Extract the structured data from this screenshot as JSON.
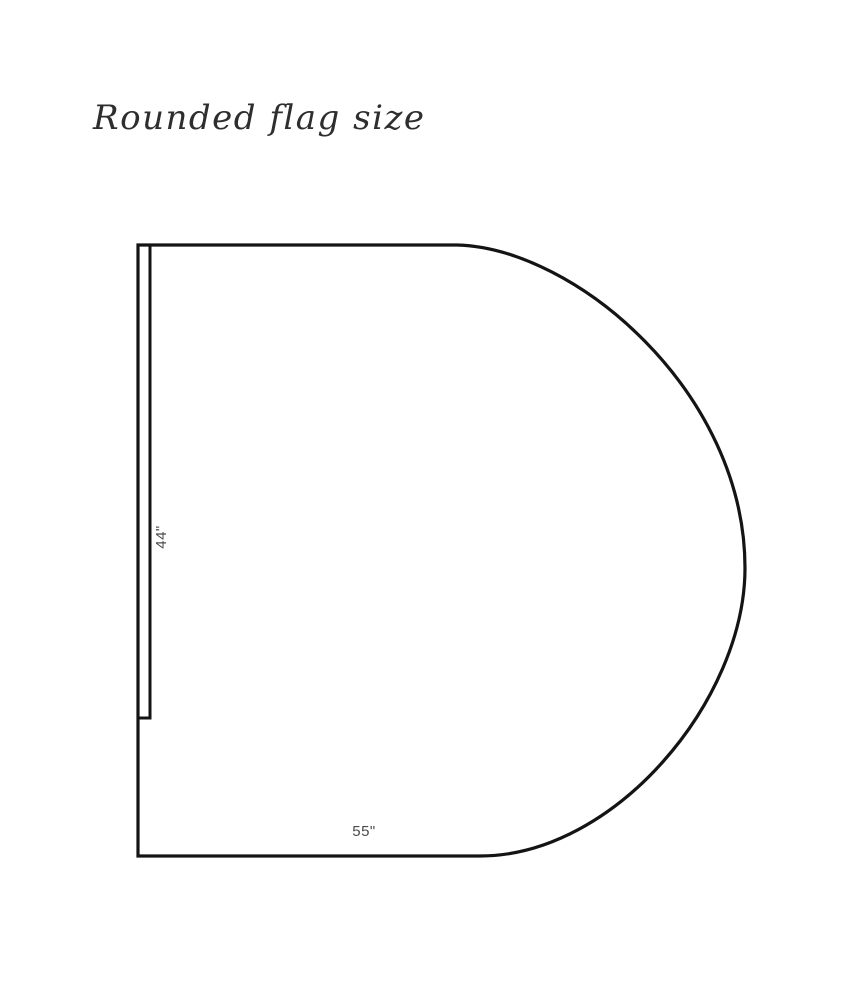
{
  "title": {
    "text": "Rounded flag size"
  },
  "flag": {
    "height_label": "44\"",
    "width_label": "55\"",
    "outline_color": "#141414",
    "label_color": "#4b4b4b",
    "background_color": "#ffffff"
  }
}
